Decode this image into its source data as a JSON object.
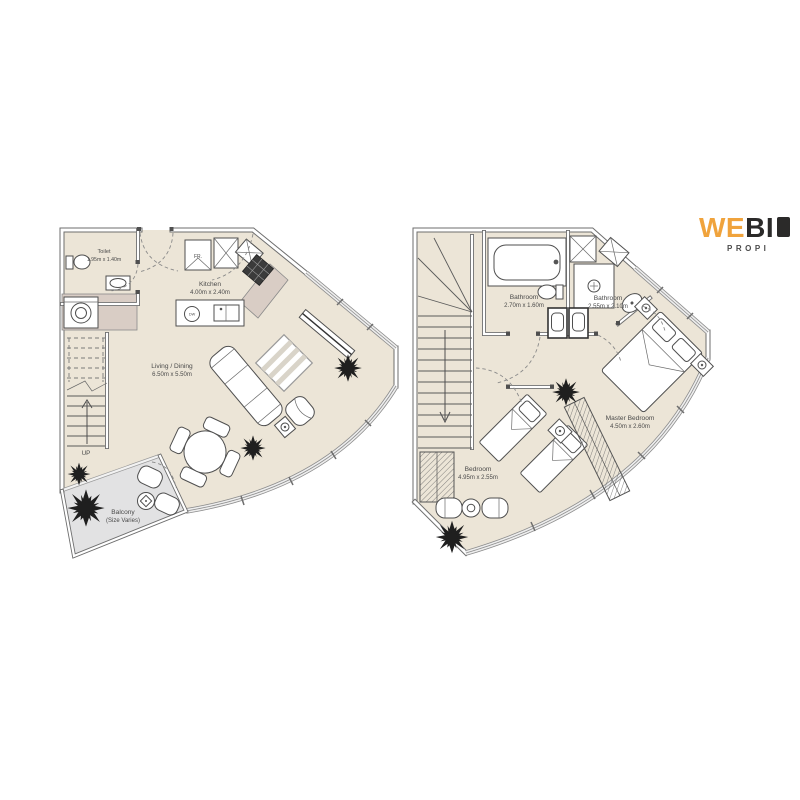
{
  "logo": {
    "brand_part1": "WE",
    "brand_part2": "BI",
    "tagline": "PROPI",
    "accent_color": "#F0A33C",
    "text_color": "#2B2A29"
  },
  "left_plan": {
    "toilet": {
      "name": "Toilet",
      "dims": "1.95m x 1.40m"
    },
    "kitchen": {
      "name": "Kitchen",
      "dims": "4.00m x 2.40m"
    },
    "living": {
      "name": "Living / Dining",
      "dims": "6.50m x 5.50m"
    },
    "balcony": {
      "name": "Balcony",
      "dims": "(Size Varies)"
    },
    "stairs_label": "UP",
    "fridge_label": "FR.",
    "dishwasher_label": "DW"
  },
  "right_plan": {
    "bathroom1": {
      "name": "Bathroom",
      "dims": "2.70m x 1.60m"
    },
    "bathroom2": {
      "name": "Bathroom",
      "dims": "2.55m x 2.10m"
    },
    "master": {
      "name": "Master Bedroom",
      "dims": "4.50m x 2.60m"
    },
    "bedroom": {
      "name": "Bedroom",
      "dims": "4.95m x 2.55m"
    }
  },
  "colors": {
    "floor": "#ECE5D7",
    "balcony_floor": "#E2E2E3",
    "counter": "#D9CDC5",
    "wall": "#6E6E6E",
    "plant": "#1F1F1F",
    "text": "#4A4A4A"
  }
}
